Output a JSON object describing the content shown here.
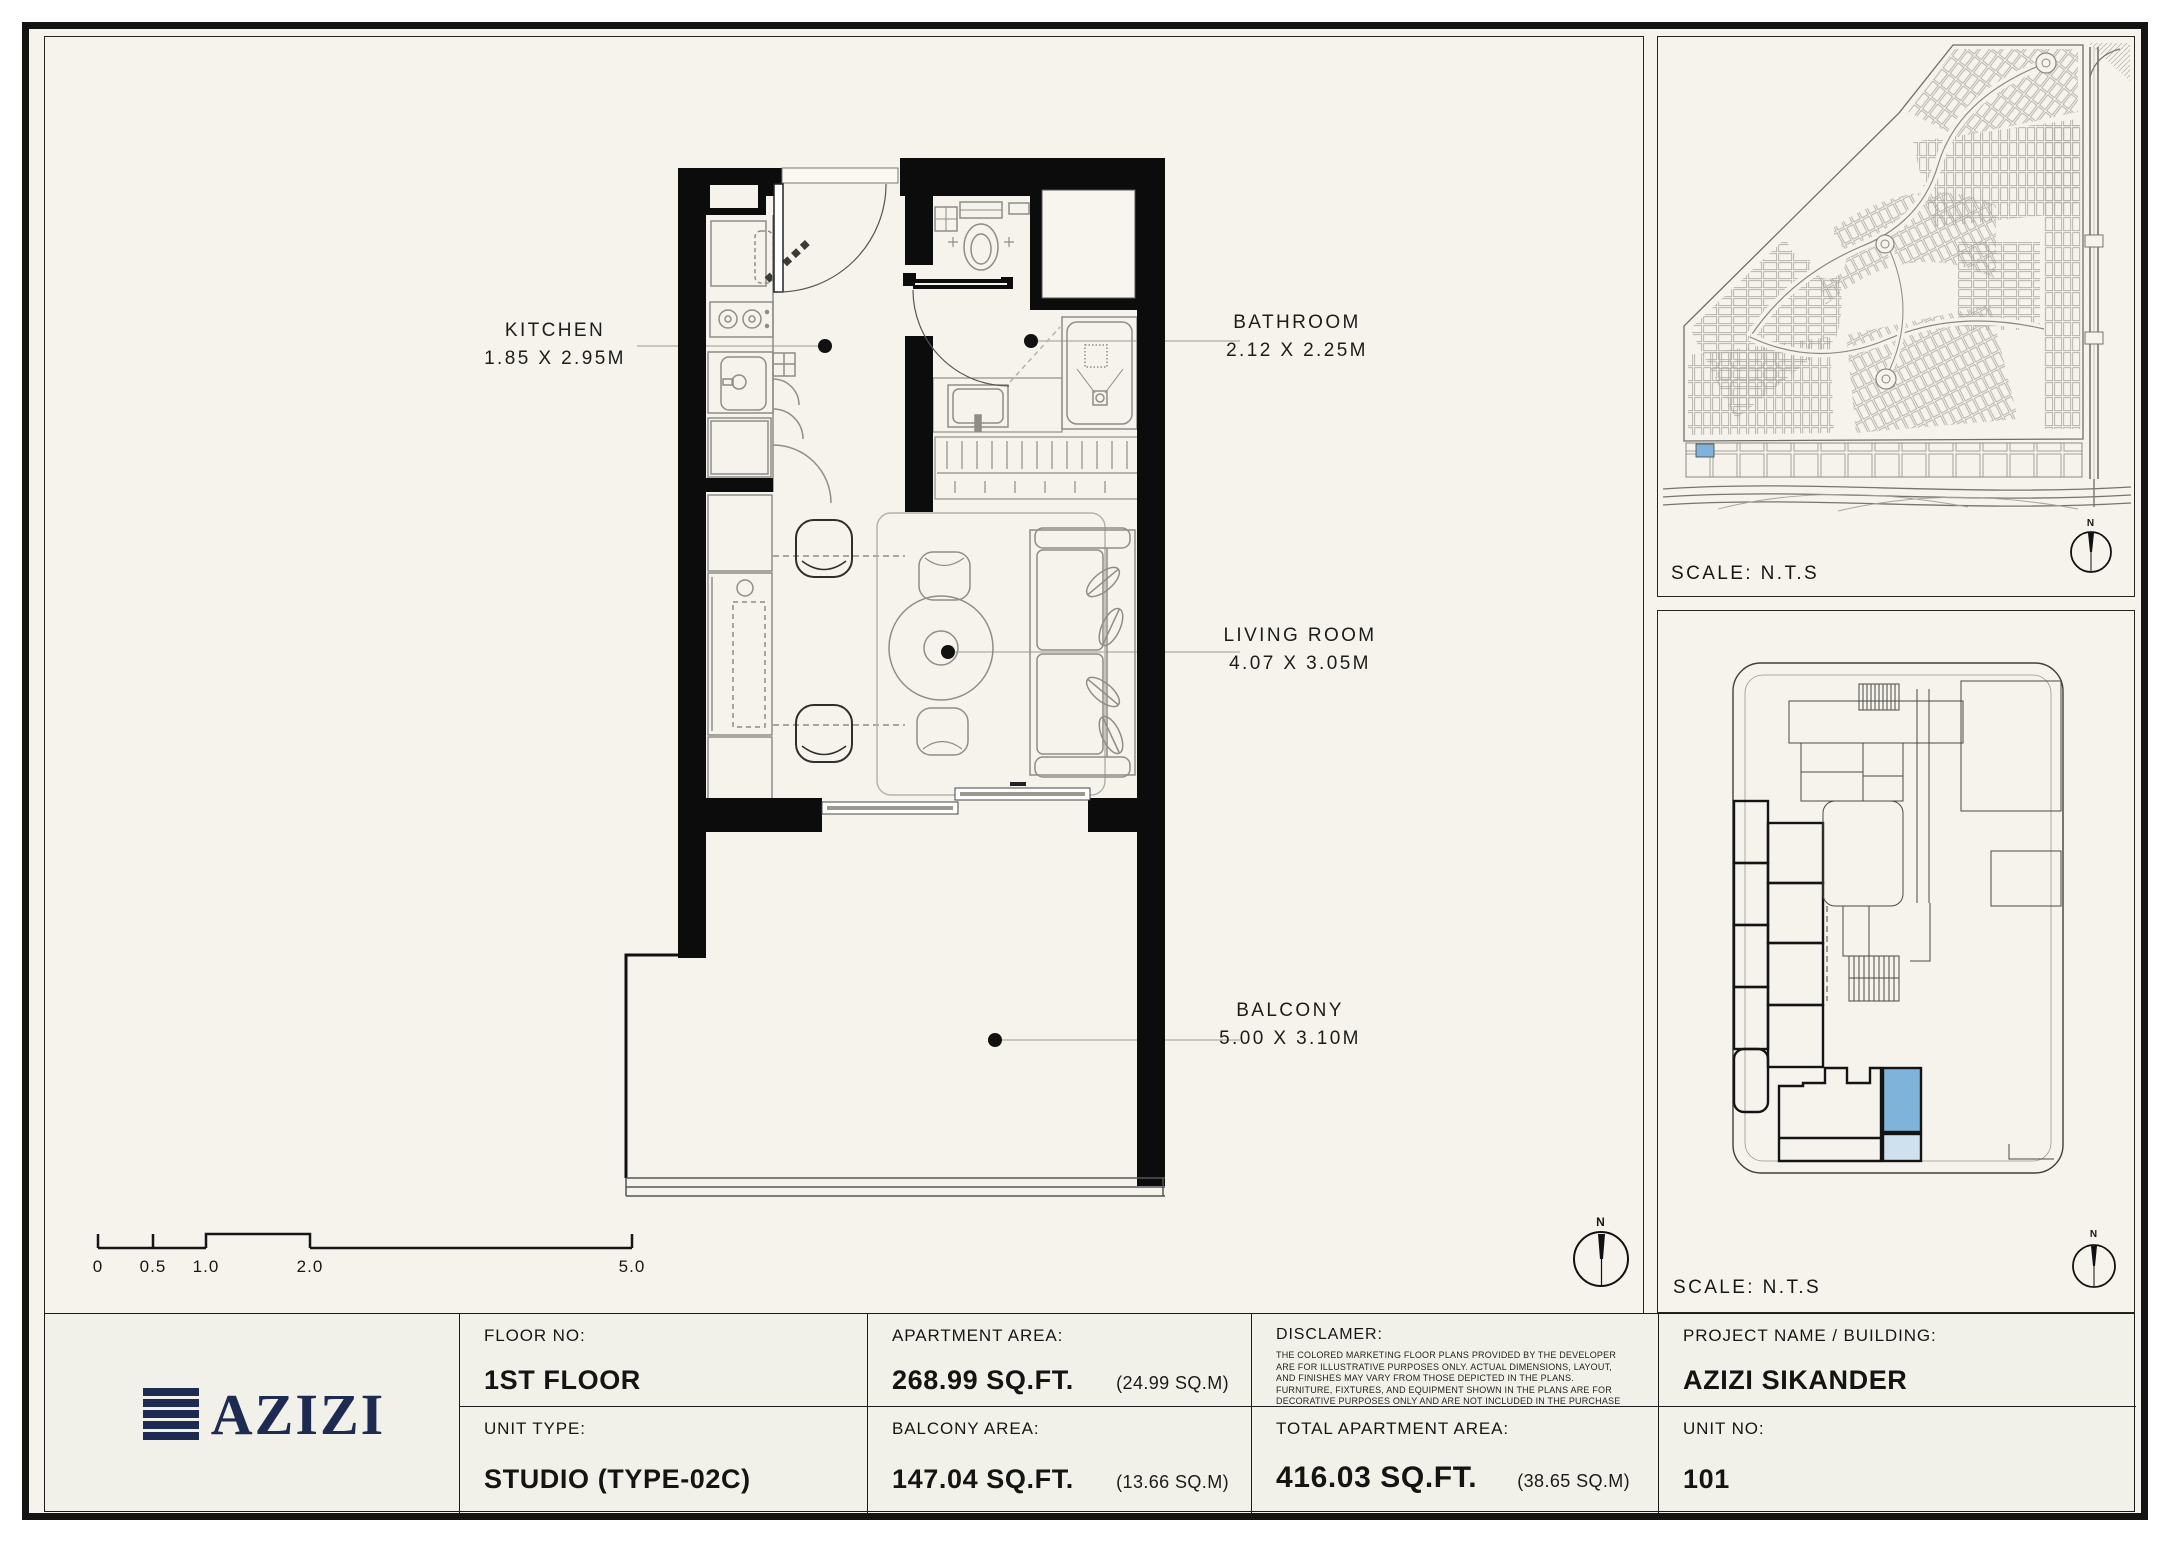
{
  "sheet": {
    "plan": {
      "rooms": [
        {
          "name": "KITCHEN",
          "dims": "1.85 X 2.95M"
        },
        {
          "name": "BATHROOM",
          "dims": "2.12 X 2.25M"
        },
        {
          "name": "LIVING ROOM",
          "dims": "4.07 X 3.05M"
        },
        {
          "name": "BALCONY",
          "dims": "5.00 X 3.10M"
        }
      ],
      "scale_bar_labels": [
        "0",
        "0.5",
        "1.0",
        "2.0",
        "5.0"
      ],
      "north": "N"
    },
    "site_map": {
      "scale_label": "SCALE: N.T.S",
      "north": "N"
    },
    "key_plan": {
      "scale_label": "SCALE: N.T.S",
      "north": "N"
    },
    "title_block": {
      "logo_text": "AZIZI",
      "floor_no_label": "FLOOR NO:",
      "floor_no": "1ST FLOOR",
      "unit_type_label": "UNIT TYPE:",
      "unit_type": "STUDIO (TYPE-02C)",
      "apartment_area_label": "APARTMENT AREA:",
      "apartment_area": "268.99 SQ.FT.",
      "apartment_area_m": "(24.99 SQ.M)",
      "balcony_area_label": "BALCONY AREA:",
      "balcony_area": "147.04 SQ.FT.",
      "balcony_area_m": "(13.66 SQ.M)",
      "disclaimer_label": "DISCLAMER:",
      "disclaimer_text": "THE COLORED MARKETING FLOOR PLANS PROVIDED BY THE DEVELOPER ARE FOR ILLUSTRATIVE PURPOSES ONLY. ACTUAL DIMENSIONS, LAYOUT, AND FINISHES MAY VARY FROM THOSE DEPICTED IN THE PLANS. FURNITURE, FIXTURES, AND EQUIPMENT SHOWN IN THE PLANS ARE FOR DECORATIVE PURPOSES ONLY AND ARE NOT INCLUDED IN THE PURCHASE OR LEASE OF THE PROPERTY. THE DEVELOPER RESERVES THE RIGHT TO MAKE MODIFICATIONS, REVISIONS, AND CHANGES TO THE FLOOR PLANS, SPECIFICATIONS, AND FEATURES WITHOUT PRIOR NOTICE.",
      "total_area_label": "TOTAL APARTMENT AREA:",
      "total_area": "416.03 SQ.FT.",
      "total_area_m": "(38.65 SQ.M)",
      "project_label": "PROJECT NAME / BUILDING:",
      "project": "AZIZI SIKANDER",
      "unit_no_label": "UNIT NO:",
      "unit_no": "101"
    },
    "colors": {
      "highlight": "#7fb3d9",
      "highlight_light": "#cfe0ee",
      "logo_navy": "#1d2a52"
    }
  }
}
